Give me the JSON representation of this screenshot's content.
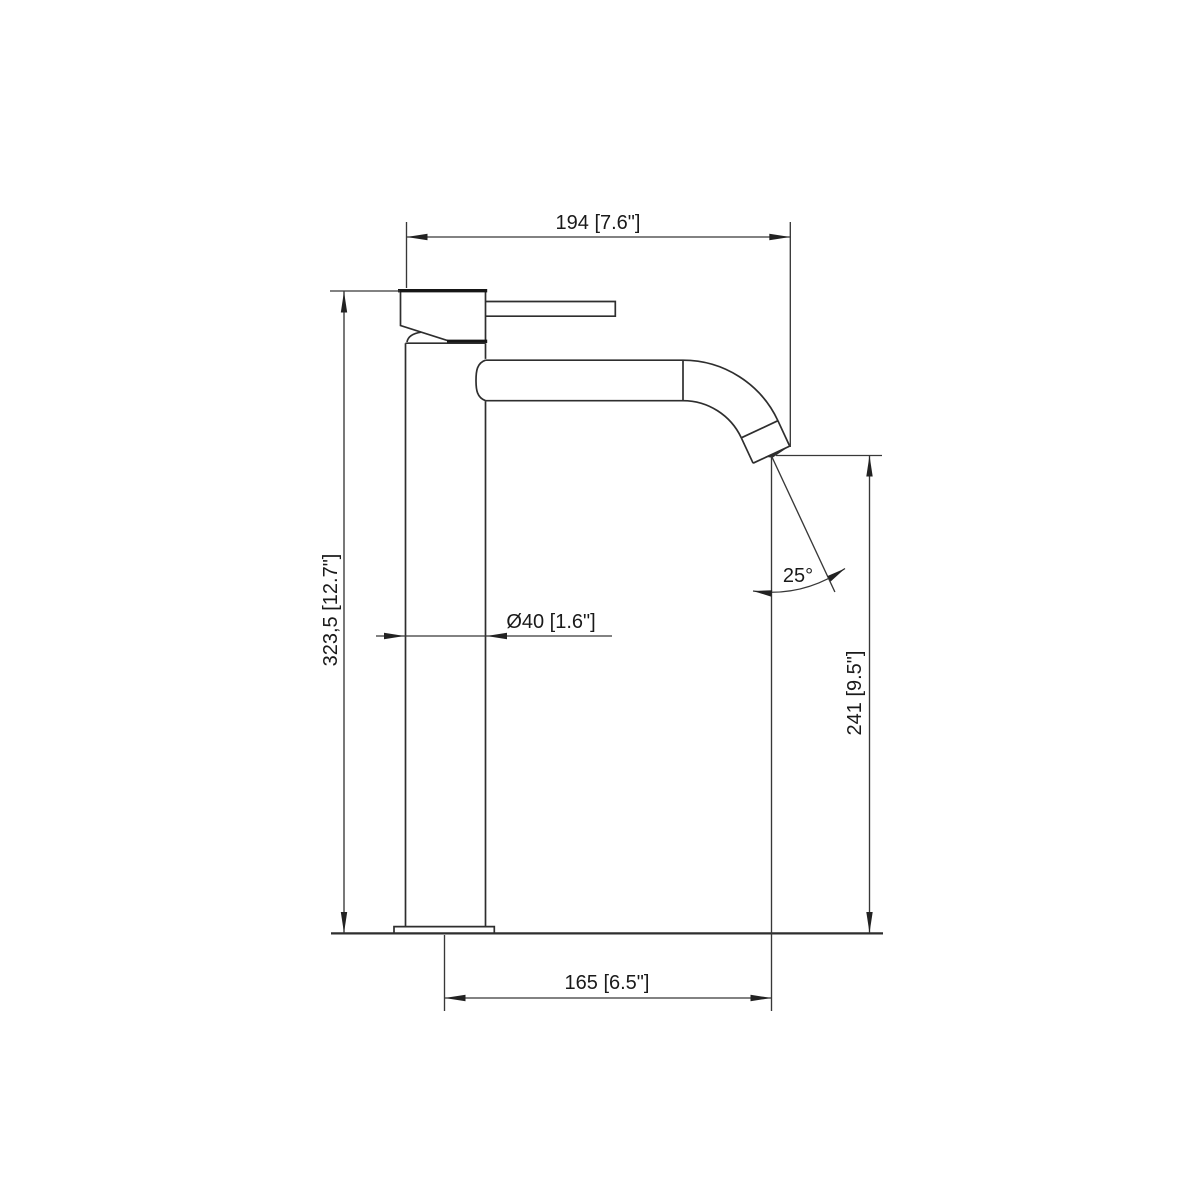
{
  "canvas": {
    "background": "#ffffff",
    "line_color": "#2e2e2e",
    "text_color": "#1a1a1a"
  },
  "drawing": {
    "subject": "tall single-lever faucet, side elevation technical drawing",
    "labels": {
      "top_width": "194 [7.6\"]",
      "overall_height": "323,5 [12.7\"]",
      "body_diameter": "Ø40 [1.6\"]",
      "spout_angle": "25°",
      "outlet_height": "241 [9.5\"]",
      "spout_reach": "165 [6.5\"]"
    }
  }
}
